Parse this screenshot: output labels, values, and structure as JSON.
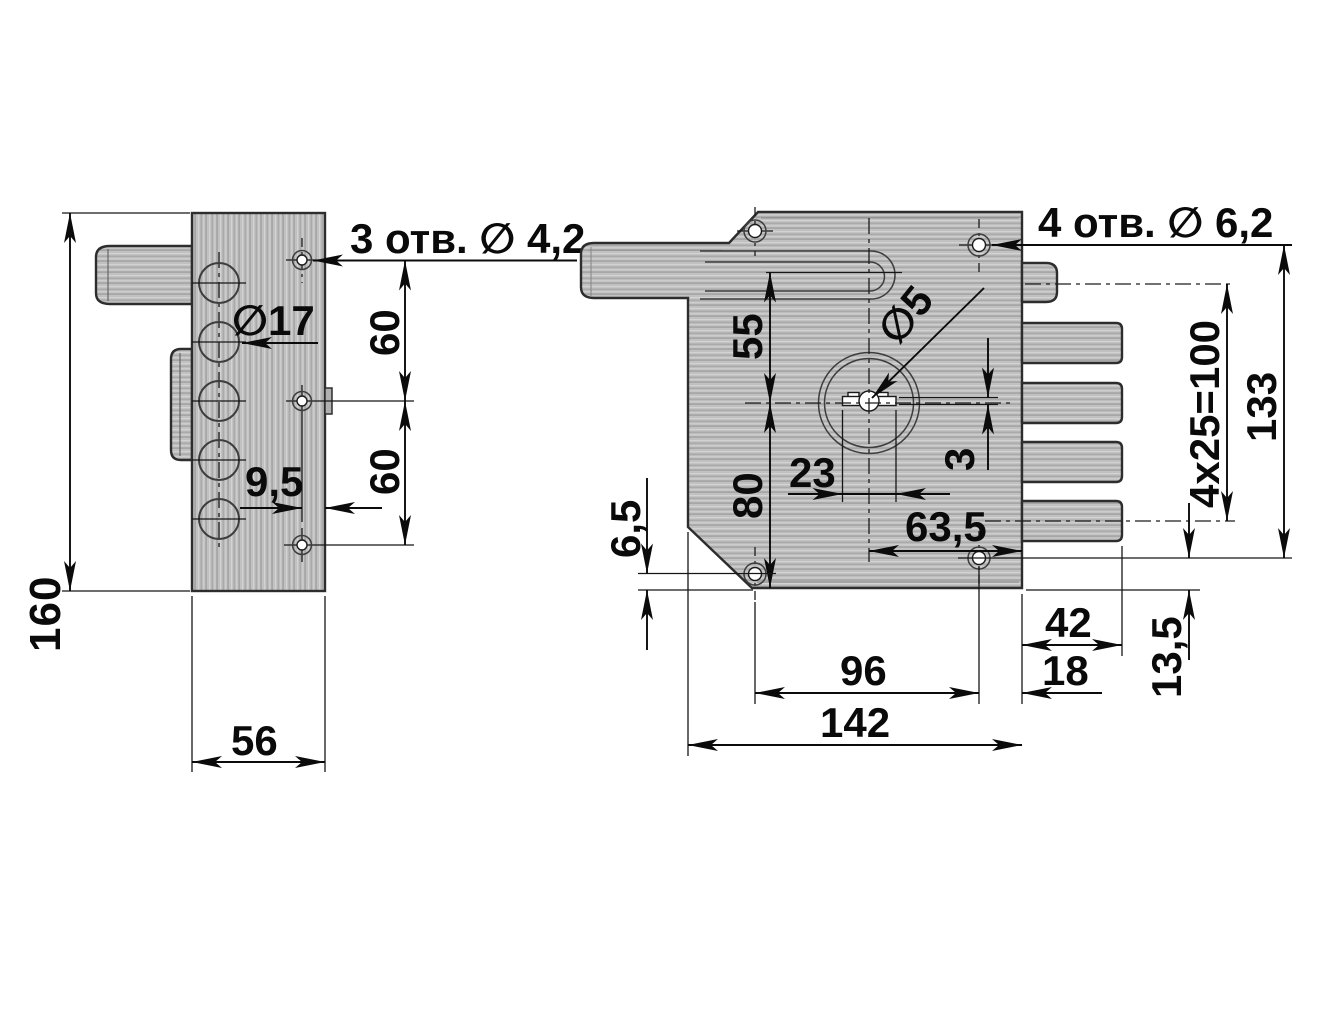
{
  "title": "Lock dimensional drawing",
  "colors": {
    "paper": "#ffffff",
    "ink": "#0b0b0b",
    "metal_light": "#d2d2d2",
    "metal_dark": "#9e9e9e"
  },
  "side_view": {
    "dim_height": "160",
    "dim_width": "56",
    "holes_note": "3 отв. ∅ 4,2",
    "dia_cylinder": "∅17",
    "dim_hole_top": "60",
    "dim_hole_bottom": "60",
    "dim_offset": "9,5"
  },
  "front_view": {
    "holes_note": "4 отв. ∅ 6,2",
    "dim_top": "55",
    "dim_bottom": "80",
    "dim_chamfer": "6,5",
    "dim_keyway_len": "23",
    "dia_key_pin": "∅5",
    "dim_keyway_width": "3",
    "dim_key_offset": "63,5",
    "dim_bolt_pitch": "4x25=100",
    "dim_holes_span": "133",
    "dim_hole_edge": "13,5",
    "dim_bolt_len": "42",
    "dim_hole_offset": "18",
    "dim_holes_h": "96",
    "dim_width": "142"
  }
}
